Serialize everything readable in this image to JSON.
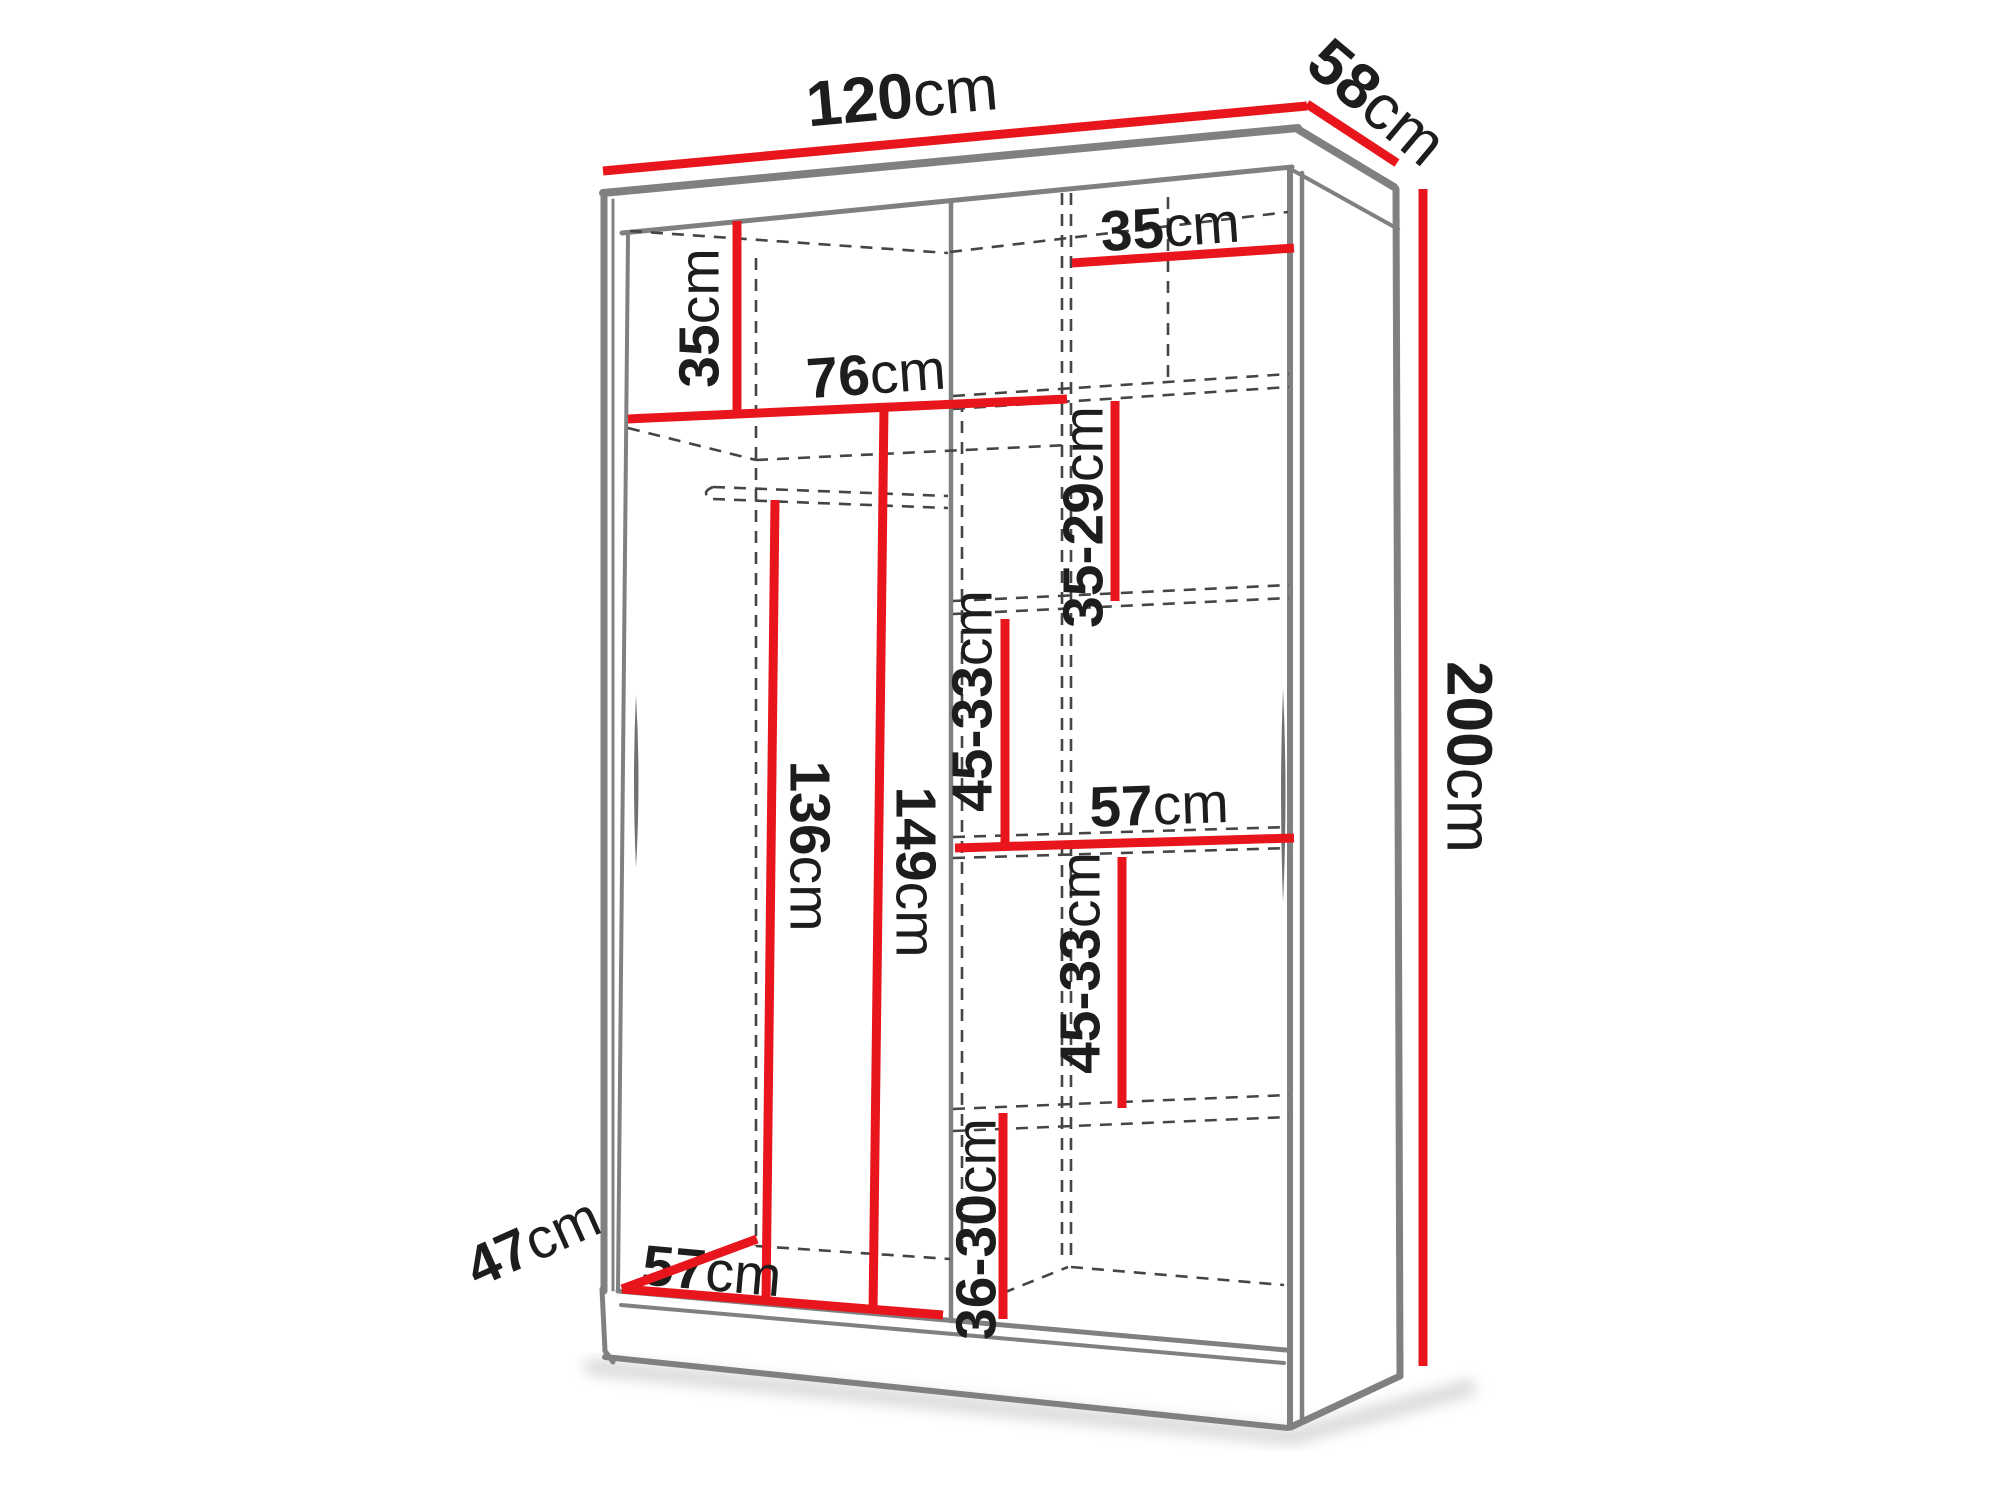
{
  "diagram": {
    "description": "Sliding-door wardrobe interior dimension diagram",
    "canvas": {
      "width": 2000,
      "height": 1500,
      "background": "#ffffff"
    },
    "colors": {
      "dimension_red": "#e8161c",
      "edge_gray": "#7e8082",
      "dashed_gray": "#454545",
      "label_black": "#1d1d1b",
      "shadow_gray": "#a8aaac"
    },
    "dimensions": [
      {
        "id": "overall-width",
        "value": "120",
        "unit": "cm",
        "line": "M603,171 L1307,106",
        "label": {
          "x": 902,
          "y": 96,
          "rotate": -5.3,
          "size": 64
        }
      },
      {
        "id": "overall-depth",
        "value": "58",
        "unit": "cm",
        "line": "M1307,104 L1397,163",
        "label": {
          "x": 1377,
          "y": 102,
          "rotate": 40,
          "size": 64
        }
      },
      {
        "id": "overall-height",
        "value": "200",
        "unit": "cm",
        "line": "M1423,189 L1423,1366",
        "label": {
          "x": 1469,
          "y": 757,
          "rotate": 90,
          "size": 64
        }
      },
      {
        "id": "left-top-shelf-height",
        "value": "35",
        "unit": "cm",
        "line": "M737,221 L737,413",
        "label": {
          "x": 699,
          "y": 318,
          "rotate": -90,
          "size": 57
        }
      },
      {
        "id": "left-section-width",
        "value": "76",
        "unit": "cm",
        "line": "M628,419 L1067,399",
        "label": {
          "x": 876,
          "y": 374,
          "rotate": -4,
          "size": 57
        }
      },
      {
        "id": "right-top-shelf-width",
        "value": "35",
        "unit": "cm",
        "line": "M1072,263 L1294,248",
        "label": {
          "x": 1170,
          "y": 227,
          "rotate": -4,
          "size": 57
        }
      },
      {
        "id": "right-gap-top",
        "value": "35-29",
        "unit": "cm",
        "line": "M1115,401 L1115,601",
        "label": {
          "x": 1083,
          "y": 517,
          "rotate": -90,
          "size": 57
        }
      },
      {
        "id": "right-gap-upper-mid",
        "value": "45-33",
        "unit": "cm",
        "line": "M1005,619 L1005,843",
        "label": {
          "x": 972,
          "y": 701,
          "rotate": -90,
          "size": 57
        }
      },
      {
        "id": "right-shelf-width",
        "value": "57",
        "unit": "cm",
        "line": "M955,848 L1294,838",
        "label": {
          "x": 1159,
          "y": 805,
          "rotate": -2,
          "size": 57
        }
      },
      {
        "id": "right-gap-lower-mid",
        "value": "45-33",
        "unit": "cm",
        "line": "M1122,857 L1122,1108",
        "label": {
          "x": 1080,
          "y": 963,
          "rotate": -90,
          "size": 57
        }
      },
      {
        "id": "right-gap-bottom",
        "value": "36-30",
        "unit": "cm",
        "line": "M1003,1113 L1003,1319",
        "label": {
          "x": 976,
          "y": 1229,
          "rotate": -90,
          "size": 57
        }
      },
      {
        "id": "left-hanging-space",
        "value": "136",
        "unit": "cm",
        "line": "M775,500 L766,1303",
        "label": {
          "x": 810,
          "y": 846,
          "rotate": 90,
          "size": 57
        }
      },
      {
        "id": "left-interior-height",
        "value": "149",
        "unit": "cm",
        "line": "M884,407 L873,1313",
        "label": {
          "x": 916,
          "y": 872,
          "rotate": 90,
          "size": 57
        }
      },
      {
        "id": "bottom-left-width",
        "value": "57",
        "unit": "cm",
        "line": "M622,1289 L943,1315",
        "label": {
          "x": 712,
          "y": 1271,
          "rotate": 5,
          "size": 57
        }
      },
      {
        "id": "bottom-depth",
        "value": "47",
        "unit": "cm",
        "line": "M622,1289 L757,1239",
        "label": {
          "x": 533,
          "y": 1242,
          "rotate": -24,
          "size": 57
        }
      }
    ],
    "edges": [
      {
        "id": "top-front-outer",
        "d": "M603,193 L1298,128",
        "w": 8
      },
      {
        "id": "top-front-inner",
        "d": "M622,233 L1292,167",
        "w": 5
      },
      {
        "id": "top-back",
        "d": "M1299,130 L1394,187",
        "w": 8
      },
      {
        "id": "side-top",
        "d": "M1294,171 L1398,229",
        "w": 4
      },
      {
        "id": "left-outer-a",
        "d": "M604,193 L604,1291",
        "w": 7
      },
      {
        "id": "left-outer-b",
        "d": "M613,200 L613,1290",
        "w": 3
      },
      {
        "id": "left-inner-wall",
        "d": "M628,236 L618,1290",
        "w": 4
      },
      {
        "id": "right-front-a",
        "d": "M1290,168 L1290,1424",
        "w": 6
      },
      {
        "id": "right-front-b",
        "d": "M1302,173 L1302,1419",
        "w": 4.5
      },
      {
        "id": "right-outer",
        "d": "M1396,189 L1400,1376",
        "w": 7
      },
      {
        "id": "right-bottom",
        "d": "M1400,1376 L1291,1427",
        "w": 7
      },
      {
        "id": "floor-front-a",
        "d": "M618,1291 L1286,1350",
        "w": 5
      },
      {
        "id": "floor-front-b",
        "d": "M621,1305 L1284,1363",
        "w": 4
      },
      {
        "id": "plinth-bottom",
        "d": "M605,1357 L1288,1428",
        "w": 6
      },
      {
        "id": "plinth-left",
        "d": "M602,1289 L605,1351 L613,1362",
        "w": 5
      },
      {
        "id": "middle-partition",
        "d": "M951,202 L951,1321",
        "w": 4.5
      }
    ],
    "dashed_edges": [
      {
        "id": "back-left-corner",
        "d": "M756,258 L756,1246"
      },
      {
        "id": "back-top-left",
        "d": "M630,231 L948,253"
      },
      {
        "id": "back-top-right",
        "d": "M950,252 L1288,212"
      },
      {
        "id": "partition-back-a",
        "d": "M1062,193 L1062,1263"
      },
      {
        "id": "partition-back-b",
        "d": "M1071,193 L1071,1263"
      },
      {
        "id": "right-col-back-left",
        "d": "M962,400 L962,1258"
      },
      {
        "id": "back-right-top",
        "d": "M1168,197 L1168,386"
      },
      {
        "id": "left-shelf-diagonal",
        "d": "M628,428 L756,460"
      },
      {
        "id": "left-shelf-back",
        "d": "M756,460 L1069,445"
      },
      {
        "id": "hanging-rail-top",
        "d": "M713,487 L948,496"
      },
      {
        "id": "hanging-rail-bottom",
        "d": "M713,499 L948,508"
      },
      {
        "id": "hanging-rail-end",
        "d": "M713,487 Q699,493 713,499"
      },
      {
        "id": "right-shelf-1a",
        "d": "M953,396 L1289,374"
      },
      {
        "id": "right-shelf-1b",
        "d": "M953,409 L1289,387"
      },
      {
        "id": "right-shelf-2a",
        "d": "M953,601 L1289,585"
      },
      {
        "id": "right-shelf-2b",
        "d": "M953,614 L1289,598"
      },
      {
        "id": "right-shelf-3a",
        "d": "M953,837 L1289,827"
      },
      {
        "id": "right-shelf-3b",
        "d": "M953,858 L1289,848"
      },
      {
        "id": "right-shelf-4a",
        "d": "M953,1109 L1289,1095"
      },
      {
        "id": "right-shelf-4b",
        "d": "M953,1131 L1289,1117"
      },
      {
        "id": "floor-back-left",
        "d": "M756,1246 L950,1259"
      },
      {
        "id": "floor-back-right",
        "d": "M1071,1267 L1284,1285"
      },
      {
        "id": "floor-diag-right",
        "d": "M1003,1293 L1068,1267"
      }
    ],
    "slivers": [
      {
        "id": "left-door-edge",
        "d": "M636,695 Q641,781 636,868 Q632,781 636,695"
      },
      {
        "id": "right-door-edge",
        "d": "M1283,688 Q1288,795 1283,902 Q1279,795 1283,688"
      }
    ],
    "shadow": {
      "d": "M592,1367 L1292,1437 L1468,1388",
      "w": 16
    }
  }
}
